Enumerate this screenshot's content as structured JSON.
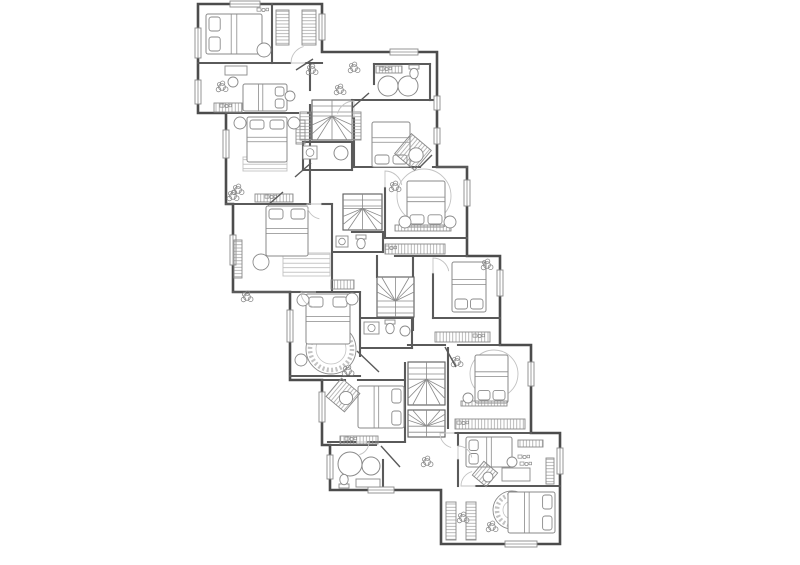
{
  "meta": {
    "label": "architectural floor plan, upper storey of a stepped multi-unit house",
    "canvas": {
      "w": 800,
      "h": 565
    }
  },
  "colors": {
    "background": "#ffffff",
    "outer_wall": "#4c4c4c",
    "inner_wall": "#5a5a5a",
    "furniture": "#8a8a8a",
    "light": "#c2c2c2",
    "hatch": "#9a9a9a"
  },
  "plan": {
    "outline": [
      198,
      4,
      322,
      4,
      322,
      52,
      437,
      52,
      437,
      167,
      467,
      167,
      467,
      256,
      500,
      256,
      500,
      345,
      531,
      345,
      531,
      433,
      560,
      433,
      560,
      544,
      441,
      544,
      441,
      490,
      330,
      490,
      330,
      445,
      322,
      445,
      322,
      380,
      290,
      380,
      290,
      292,
      233,
      292,
      233,
      204,
      226,
      204,
      226,
      113,
      198,
      113
    ],
    "walls": [
      [
        198,
        63,
        290,
        63
      ],
      [
        306,
        63,
        322,
        63
      ],
      [
        272,
        4,
        272,
        63
      ],
      [
        226,
        113,
        298,
        113
      ],
      [
        308,
        113,
        310,
        113
      ],
      [
        310,
        63,
        310,
        90
      ],
      [
        310,
        105,
        310,
        204
      ],
      [
        226,
        204,
        308,
        204
      ],
      [
        322,
        204,
        332,
        204
      ],
      [
        332,
        204,
        332,
        292
      ],
      [
        233,
        292,
        332,
        292
      ],
      [
        303,
        142,
        352,
        142
      ],
      [
        303,
        142,
        303,
        170
      ],
      [
        303,
        170,
        352,
        170
      ],
      [
        352,
        142,
        352,
        170
      ],
      [
        354,
        118,
        354,
        167
      ],
      [
        354,
        100,
        374,
        100
      ],
      [
        430,
        100,
        437,
        100
      ],
      [
        374,
        64,
        430,
        64
      ],
      [
        374,
        64,
        374,
        84
      ],
      [
        374,
        100,
        430,
        100
      ],
      [
        430,
        64,
        430,
        100
      ],
      [
        354,
        167,
        420,
        167
      ],
      [
        433,
        167,
        467,
        167
      ],
      [
        385,
        188,
        385,
        238
      ],
      [
        385,
        238,
        467,
        238
      ],
      [
        352,
        232,
        383,
        232
      ],
      [
        383,
        232,
        383,
        252
      ],
      [
        333,
        252,
        383,
        252
      ],
      [
        395,
        256,
        467,
        256
      ],
      [
        413,
        256,
        413,
        330
      ],
      [
        433,
        274,
        433,
        318
      ],
      [
        433,
        318,
        500,
        318
      ],
      [
        408,
        345,
        445,
        345
      ],
      [
        458,
        345,
        500,
        345
      ],
      [
        448,
        348,
        448,
        428
      ],
      [
        405,
        363,
        405,
        442
      ],
      [
        322,
        380,
        345,
        380
      ],
      [
        358,
        380,
        405,
        380
      ],
      [
        290,
        376,
        360,
        376
      ],
      [
        360,
        292,
        360,
        356
      ],
      [
        362,
        318,
        412,
        318
      ],
      [
        362,
        348,
        412,
        348
      ],
      [
        412,
        318,
        412,
        348
      ],
      [
        290,
        292,
        302,
        292
      ],
      [
        316,
        292,
        360,
        292
      ],
      [
        328,
        442,
        356,
        442
      ],
      [
        368,
        442,
        405,
        442
      ],
      [
        330,
        445,
        376,
        445
      ],
      [
        383,
        460,
        383,
        490
      ],
      [
        455,
        433,
        531,
        433
      ],
      [
        458,
        433,
        458,
        445
      ],
      [
        458,
        460,
        458,
        486
      ],
      [
        476,
        486,
        560,
        486
      ],
      [
        352,
        100,
        352,
        118
      ],
      [
        377,
        256,
        377,
        277
      ]
    ],
    "windows": [
      [
        230,
        1,
        30,
        6
      ],
      [
        195,
        28,
        6,
        30
      ],
      [
        195,
        80,
        6,
        24
      ],
      [
        319,
        14,
        6,
        26
      ],
      [
        223,
        130,
        6,
        28
      ],
      [
        230,
        235,
        6,
        30
      ],
      [
        287,
        310,
        6,
        32
      ],
      [
        319,
        392,
        6,
        30
      ],
      [
        327,
        455,
        6,
        24
      ],
      [
        368,
        487,
        26,
        6
      ],
      [
        505,
        541,
        32,
        6
      ],
      [
        557,
        448,
        6,
        26
      ],
      [
        528,
        362,
        6,
        24
      ],
      [
        497,
        270,
        6,
        26
      ],
      [
        464,
        180,
        6,
        26
      ],
      [
        434,
        96,
        6,
        14
      ],
      [
        434,
        128,
        6,
        16
      ],
      [
        390,
        49,
        28,
        6
      ]
    ],
    "stairs": [
      {
        "x": 312,
        "y": 100,
        "w": 40,
        "h": 40,
        "winder": "S"
      },
      {
        "x": 343,
        "y": 194,
        "w": 39,
        "h": 36,
        "winder": "S"
      },
      {
        "x": 377,
        "y": 277,
        "w": 37,
        "h": 40,
        "winder": "N"
      },
      {
        "x": 408,
        "y": 362,
        "w": 37,
        "h": 43,
        "winder": "S"
      },
      {
        "x": 408,
        "y": 410,
        "w": 37,
        "h": 27,
        "winder": "N"
      }
    ],
    "beds": [
      {
        "x": 206,
        "y": 14,
        "w": 56,
        "h": 40,
        "head": "W"
      },
      {
        "x": 243,
        "y": 84,
        "w": 44,
        "h": 27,
        "head": "E"
      },
      {
        "x": 247,
        "y": 117,
        "w": 40,
        "h": 45,
        "head": "N"
      },
      {
        "x": 372,
        "y": 122,
        "w": 38,
        "h": 45,
        "head": "S"
      },
      {
        "x": 266,
        "y": 206,
        "w": 42,
        "h": 50,
        "head": "N"
      },
      {
        "x": 407,
        "y": 181,
        "w": 38,
        "h": 46,
        "head": "S"
      },
      {
        "x": 306,
        "y": 294,
        "w": 44,
        "h": 50,
        "head": "N"
      },
      {
        "x": 452,
        "y": 262,
        "w": 34,
        "h": 50,
        "head": "S"
      },
      {
        "x": 475,
        "y": 355,
        "w": 33,
        "h": 48,
        "head": "S"
      },
      {
        "x": 358,
        "y": 386,
        "w": 46,
        "h": 42,
        "head": "E"
      },
      {
        "x": 466,
        "y": 437,
        "w": 46,
        "h": 30,
        "head": "W"
      },
      {
        "x": 508,
        "y": 492,
        "w": 47,
        "h": 41,
        "head": "E"
      }
    ],
    "wardrobes": [
      [
        276,
        10,
        13,
        35
      ],
      [
        302,
        10,
        14,
        35
      ],
      [
        214,
        103,
        28,
        9
      ],
      [
        300,
        112,
        11,
        28
      ],
      [
        352,
        112,
        9,
        28
      ],
      [
        255,
        194,
        38,
        8
      ],
      [
        296,
        120,
        9,
        24
      ],
      [
        234,
        240,
        8,
        38
      ],
      [
        331,
        280,
        23,
        9
      ],
      [
        385,
        244,
        60,
        10
      ],
      [
        435,
        332,
        55,
        10
      ],
      [
        455,
        419,
        70,
        10
      ],
      [
        340,
        436,
        38,
        8
      ],
      [
        518,
        440,
        25,
        7
      ],
      [
        546,
        458,
        8,
        26
      ],
      [
        446,
        502,
        10,
        38
      ],
      [
        466,
        502,
        10,
        38
      ],
      [
        395,
        225,
        56,
        6
      ],
      [
        461,
        401,
        46,
        5
      ],
      [
        376,
        66,
        26,
        7
      ]
    ],
    "rugs_rect": [
      [
        243,
        157,
        44,
        14
      ],
      [
        283,
        253,
        47,
        23
      ]
    ],
    "rugs_round": [
      {
        "cx": 331,
        "cy": 349,
        "r": 25,
        "deco": true
      },
      {
        "cx": 424,
        "cy": 196,
        "r": 27,
        "deco": false
      },
      {
        "cx": 494,
        "cy": 374,
        "r": 24,
        "deco": false
      },
      {
        "cx": 512,
        "cy": 510,
        "r": 19,
        "deco": true
      }
    ],
    "circles": [
      [
        240,
        123,
        6
      ],
      [
        294,
        123,
        6
      ],
      [
        264,
        50,
        7
      ],
      [
        290,
        96,
        5
      ],
      [
        405,
        222,
        6
      ],
      [
        450,
        222,
        6
      ],
      [
        303,
        300,
        6
      ],
      [
        352,
        299,
        6
      ],
      [
        301,
        360,
        6
      ],
      [
        468,
        398,
        5
      ],
      [
        261,
        262,
        8
      ],
      [
        233,
        82,
        5
      ],
      [
        512,
        462,
        5
      ],
      [
        405,
        331,
        5
      ]
    ],
    "diamonds": [
      [
        413,
        152,
        13
      ],
      [
        343,
        395,
        12
      ],
      [
        485,
        474,
        9
      ]
    ],
    "desks": [
      [
        225,
        66,
        22,
        9
      ],
      [
        502,
        468,
        28,
        13
      ]
    ],
    "benches": [
      [
        356,
        479,
        24,
        8
      ]
    ],
    "plants": [
      [
        222,
        87
      ],
      [
        238,
        190
      ],
      [
        312,
        70
      ],
      [
        340,
        90
      ],
      [
        395,
        187
      ],
      [
        348,
        371
      ],
      [
        457,
        362
      ],
      [
        427,
        462
      ],
      [
        487,
        265
      ],
      [
        463,
        518
      ],
      [
        492,
        527
      ],
      [
        354,
        68
      ],
      [
        233,
        196
      ],
      [
        247,
        297
      ]
    ],
    "deco": [
      [
        262,
        10
      ],
      [
        385,
        69
      ],
      [
        523,
        457
      ],
      [
        270,
        197
      ],
      [
        225,
        106
      ],
      [
        350,
        439
      ],
      [
        390,
        248
      ],
      [
        478,
        336
      ],
      [
        462,
        423
      ],
      [
        525,
        464
      ]
    ],
    "sinks_round": [
      [
        388,
        86,
        10
      ],
      [
        408,
        86,
        10
      ],
      [
        350,
        464,
        12
      ],
      [
        371,
        466,
        9
      ],
      [
        341,
        153,
        7
      ]
    ],
    "sinks_square": [
      [
        303,
        146,
        14,
        13
      ],
      [
        336,
        236,
        12,
        11
      ],
      [
        364,
        322,
        15,
        12
      ]
    ],
    "toilets": [
      [
        414,
        72,
        0
      ],
      [
        361,
        242,
        0
      ],
      [
        390,
        327,
        0
      ],
      [
        344,
        481,
        180
      ]
    ],
    "doors": [
      {
        "hx": 308,
        "hy": 63,
        "r": 17,
        "a": 180,
        "sweep": 75
      },
      {
        "hx": 354,
        "hy": 118,
        "r": 17,
        "a": 270,
        "sweep": -75
      },
      {
        "hx": 385,
        "hy": 188,
        "r": 17,
        "a": 270,
        "sweep": 80
      },
      {
        "hx": 433,
        "hy": 274,
        "r": 16,
        "a": 270,
        "sweep": 80
      },
      {
        "hx": 322,
        "hy": 204,
        "r": 15,
        "a": 180,
        "sweep": -80
      },
      {
        "hx": 458,
        "hy": 460,
        "r": 14,
        "a": 270,
        "sweep": 80
      },
      {
        "hx": 356,
        "hy": 442,
        "r": 13,
        "a": 0,
        "sweep": 75
      },
      {
        "hx": 316,
        "hy": 292,
        "r": 15,
        "a": 180,
        "sweep": -80
      },
      {
        "hx": 455,
        "hy": 433,
        "r": 15,
        "a": 180,
        "sweep": -75
      },
      {
        "hx": 476,
        "hy": 486,
        "r": 15,
        "a": 180,
        "sweep": 75
      }
    ],
    "door_leaves": [
      [
        295,
        177,
        311,
        163
      ],
      [
        268,
        205,
        283,
        192
      ],
      [
        296,
        70,
        313,
        59
      ],
      [
        352,
        108,
        369,
        93
      ],
      [
        357,
        351,
        379,
        372
      ],
      [
        381,
        446,
        400,
        467
      ],
      [
        445,
        347,
        456,
        367
      ],
      [
        420,
        167,
        432,
        155
      ]
    ],
    "rooms": [
      {
        "name": "bedroom-a1",
        "bbox": [
          198,
          4,
          74,
          59
        ]
      },
      {
        "name": "walk-in-closet-a",
        "bbox": [
          272,
          4,
          50,
          58
        ]
      },
      {
        "name": "bedroom-a2",
        "bbox": [
          198,
          63,
          112,
          50
        ]
      },
      {
        "name": "bedroom-b1",
        "bbox": [
          226,
          113,
          84,
          91
        ]
      },
      {
        "name": "bathroom-b1",
        "bbox": [
          374,
          64,
          56,
          36
        ]
      },
      {
        "name": "shower-room-b",
        "bbox": [
          303,
          142,
          49,
          28
        ]
      },
      {
        "name": "bedroom-b2",
        "bbox": [
          354,
          100,
          83,
          67
        ]
      },
      {
        "name": "stair-core-1",
        "bbox": [
          312,
          100,
          40,
          40
        ]
      },
      {
        "name": "bedroom-c1",
        "bbox": [
          233,
          204,
          99,
          88
        ]
      },
      {
        "name": "stair-core-2",
        "bbox": [
          343,
          194,
          39,
          36
        ]
      },
      {
        "name": "bathroom-c",
        "bbox": [
          333,
          232,
          50,
          20
        ]
      },
      {
        "name": "bedroom-c2",
        "bbox": [
          385,
          167,
          82,
          71
        ]
      },
      {
        "name": "bedroom-d1",
        "bbox": [
          290,
          292,
          70,
          84
        ]
      },
      {
        "name": "bathroom-d",
        "bbox": [
          362,
          318,
          50,
          30
        ]
      },
      {
        "name": "stair-core-3",
        "bbox": [
          377,
          277,
          37,
          40
        ]
      },
      {
        "name": "bedroom-d2",
        "bbox": [
          433,
          256,
          67,
          62
        ]
      },
      {
        "name": "bedroom-d3",
        "bbox": [
          448,
          348,
          83,
          80
        ]
      },
      {
        "name": "bedroom-4",
        "bbox": [
          322,
          380,
          83,
          62
        ]
      },
      {
        "name": "stair-core-4",
        "bbox": [
          408,
          362,
          37,
          75
        ]
      },
      {
        "name": "bathroom-e",
        "bbox": [
          330,
          445,
          53,
          45
        ]
      },
      {
        "name": "bedroom-e1",
        "bbox": [
          458,
          433,
          102,
          53
        ]
      },
      {
        "name": "bedroom-e2",
        "bbox": [
          441,
          486,
          119,
          58
        ]
      }
    ]
  }
}
